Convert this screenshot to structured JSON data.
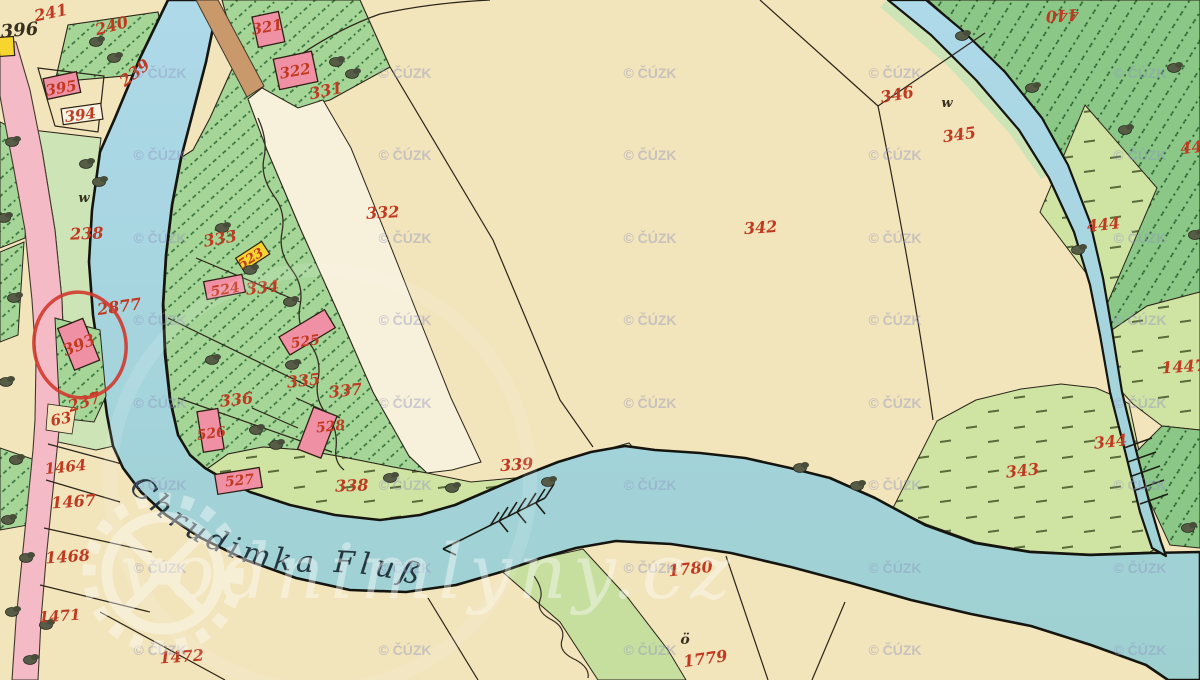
{
  "map": {
    "source_watermark": "© ČÚZK",
    "site_watermark": "vodnimlyny.cz",
    "river_label": "Chrudimka Fluß",
    "flow_direction": "downstream-arrow-pointing-southwest",
    "highlight_annotation": {
      "shape": "circle",
      "color": "#d13a2e",
      "around_parcel": "393"
    },
    "colors": {
      "paper_cream": "#f2e4bb",
      "water_blue": "#a8d6e4",
      "village_green": "#a6d598",
      "forest_green": "#8bc888",
      "meadow_green": "#cfe3a3",
      "bank_green": "#cde4b6",
      "road_pink": "#f4bac6",
      "road_brown": "#c9996b",
      "building_pink": "#f090a5",
      "building_yellow": "#f6d52e",
      "number_red": "#c03a21",
      "ink_black": "#2b251a",
      "watermark_lavender": "#8f94c0"
    },
    "watermark_grid": {
      "cols": [
        160,
        405,
        650,
        895,
        1140
      ],
      "rows": [
        78,
        160,
        243,
        325,
        408,
        490,
        573,
        655
      ]
    },
    "labels": [
      {
        "t": "241",
        "x": 52,
        "y": 18,
        "r": -12
      },
      {
        "t": "240",
        "x": 113,
        "y": 31,
        "r": -15
      },
      {
        "t": "396",
        "x": 20,
        "y": 36,
        "r": -5,
        "c": "k",
        "s": 18
      },
      {
        "t": "239",
        "x": 138,
        "y": 77,
        "r": -38
      },
      {
        "t": "395",
        "x": 62,
        "y": 93,
        "r": -10,
        "s": 15
      },
      {
        "t": "394",
        "x": 81,
        "y": 120,
        "r": -8,
        "s": 15
      },
      {
        "t": "238",
        "x": 87,
        "y": 239,
        "r": -2
      },
      {
        "t": "w",
        "x": 84,
        "y": 202,
        "c": "k",
        "s": 13
      },
      {
        "t": "321",
        "x": 268,
        "y": 32,
        "r": -10,
        "s": 15
      },
      {
        "t": "322",
        "x": 296,
        "y": 76,
        "r": -10,
        "s": 15
      },
      {
        "t": "331",
        "x": 327,
        "y": 96,
        "r": -12
      },
      {
        "t": "332",
        "x": 383,
        "y": 218,
        "r": -3
      },
      {
        "t": "333",
        "x": 221,
        "y": 244,
        "r": -10
      },
      {
        "t": "523",
        "x": 253,
        "y": 262,
        "r": -32,
        "s": 13
      },
      {
        "t": "334",
        "x": 263,
        "y": 293,
        "r": -6
      },
      {
        "t": "524",
        "x": 226,
        "y": 294,
        "r": -10,
        "s": 14
      },
      {
        "t": "525",
        "x": 306,
        "y": 346,
        "r": -8,
        "s": 14
      },
      {
        "t": "335",
        "x": 304,
        "y": 386,
        "r": -6
      },
      {
        "t": "337",
        "x": 346,
        "y": 396,
        "r": -6
      },
      {
        "t": "336",
        "x": 237,
        "y": 405,
        "r": -6
      },
      {
        "t": "526",
        "x": 212,
        "y": 438,
        "r": -8,
        "s": 14
      },
      {
        "t": "528",
        "x": 331,
        "y": 431,
        "r": -6,
        "s": 14
      },
      {
        "t": "527",
        "x": 240,
        "y": 485,
        "r": -6,
        "s": 14
      },
      {
        "t": "338",
        "x": 352,
        "y": 491,
        "r": -2
      },
      {
        "t": "339",
        "x": 517,
        "y": 470,
        "r": -4
      },
      {
        "t": "342",
        "x": 761,
        "y": 233,
        "r": -4
      },
      {
        "t": "346",
        "x": 898,
        "y": 100,
        "r": -10
      },
      {
        "t": "345",
        "x": 960,
        "y": 140,
        "r": -8
      },
      {
        "t": "440",
        "x": 1062,
        "y": 10,
        "r": 176
      },
      {
        "t": "444",
        "x": 1104,
        "y": 230,
        "r": -6
      },
      {
        "t": "44",
        "x": 1192,
        "y": 153,
        "r": -6
      },
      {
        "t": "1447",
        "x": 1184,
        "y": 372,
        "r": -4
      },
      {
        "t": "343",
        "x": 1023,
        "y": 476,
        "r": -6
      },
      {
        "t": "344",
        "x": 1111,
        "y": 447,
        "r": -6
      },
      {
        "t": "2877",
        "x": 120,
        "y": 312,
        "r": -8
      },
      {
        "t": "393",
        "x": 81,
        "y": 350,
        "r": -22
      },
      {
        "t": "237",
        "x": 86,
        "y": 407,
        "r": -18
      },
      {
        "t": "63",
        "x": 62,
        "y": 424,
        "r": -12,
        "s": 15
      },
      {
        "t": "1464",
        "x": 66,
        "y": 472,
        "r": -6,
        "s": 15
      },
      {
        "t": "1467",
        "x": 74,
        "y": 507,
        "r": -4
      },
      {
        "t": "1468",
        "x": 68,
        "y": 562,
        "r": -4
      },
      {
        "t": "1471",
        "x": 60,
        "y": 621,
        "r": -4,
        "s": 15
      },
      {
        "t": "1472",
        "x": 182,
        "y": 662,
        "r": -4
      },
      {
        "t": "1780",
        "x": 691,
        "y": 574,
        "r": -6
      },
      {
        "t": "ö",
        "x": 685,
        "y": 644,
        "c": "k",
        "s": 14
      },
      {
        "t": "1779",
        "x": 706,
        "y": 664,
        "r": -8
      },
      {
        "t": "w",
        "x": 947,
        "y": 107,
        "c": "k",
        "s": 13
      }
    ]
  }
}
